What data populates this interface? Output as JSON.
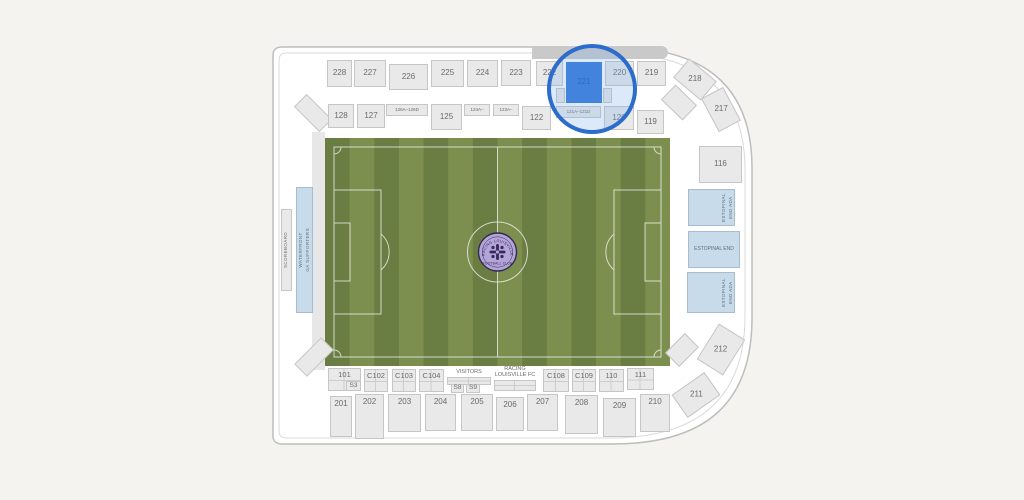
{
  "selection": {
    "selected_section": "221"
  },
  "colors": {
    "page_background": "#f5f3f0",
    "bowl_interior": "#ffffff",
    "outline": "#bdbdbd",
    "inner_outline": "#d9d9d9",
    "section_fill": "#e9e9e9",
    "section_border": "#c6c6c6",
    "blue_section_fill": "#c7dbeb",
    "blue_section_border": "#a6bdd1",
    "highlight_fill": "#2d74d9",
    "highlight_ring": "#2b6ccd",
    "stripe_dark": "#6a7d42",
    "stripe_light": "#7c8f4f",
    "field_line": "#ffffff",
    "logo_fill": "#b3a4d9",
    "logo_ring": "#322a52"
  },
  "field_logo": {
    "top_text": "RACING LOUISVILLE",
    "bottom_text": "FOOTBALL CLUB"
  },
  "sections": [
    {
      "name": "north-canopy",
      "label": "",
      "kind": "band",
      "x": 532,
      "y": 46,
      "w": 136,
      "h": 13,
      "interactable": false
    },
    {
      "name": "west-walkway",
      "label": "",
      "kind": "plain",
      "x": 312,
      "y": 132,
      "w": 13,
      "h": 238,
      "interactable": false
    },
    {
      "name": "section-corner-nw",
      "label": "",
      "x": 295,
      "y": 104,
      "w": 36,
      "h": 18,
      "rot": 45,
      "interactable": false
    },
    {
      "name": "section-corner-sw",
      "label": "",
      "x": 295,
      "y": 348,
      "w": 38,
      "h": 18,
      "rot": -45,
      "interactable": false
    },
    {
      "name": "section-corner-ne",
      "label": "",
      "x": 664,
      "y": 92,
      "w": 30,
      "h": 21,
      "rot": 44,
      "interactable": false
    },
    {
      "name": "section-corner-se",
      "label": "",
      "x": 668,
      "y": 340,
      "w": 28,
      "h": 20,
      "rot": -45,
      "interactable": false
    },
    {
      "label": "228",
      "x": 327,
      "y": 60,
      "w": 25,
      "h": 27
    },
    {
      "label": "227",
      "x": 354,
      "y": 60,
      "w": 32,
      "h": 27
    },
    {
      "label": "226",
      "x": 389,
      "y": 64,
      "w": 39,
      "h": 26
    },
    {
      "label": "225",
      "x": 431,
      "y": 60,
      "w": 33,
      "h": 27
    },
    {
      "label": "224",
      "x": 467,
      "y": 60,
      "w": 31,
      "h": 27
    },
    {
      "label": "223",
      "x": 501,
      "y": 60,
      "w": 30,
      "h": 26
    },
    {
      "label": "222",
      "x": 536,
      "y": 61,
      "w": 27,
      "h": 25
    },
    {
      "name": "stair-221-left",
      "label": "",
      "x": 556,
      "y": 88,
      "w": 9,
      "h": 15,
      "interactable": false
    },
    {
      "name": "stair-221-right",
      "label": "",
      "x": 603,
      "y": 88,
      "w": 9,
      "h": 15,
      "interactable": false
    },
    {
      "label": "221",
      "kind": "highlight",
      "x": 566,
      "y": 62,
      "w": 36,
      "h": 41
    },
    {
      "label": "220",
      "x": 605,
      "y": 61,
      "w": 29,
      "h": 25
    },
    {
      "label": "219",
      "x": 637,
      "y": 61,
      "w": 29,
      "h": 25
    },
    {
      "label": "218",
      "x": 677,
      "y": 67,
      "w": 36,
      "h": 25,
      "rot": 40
    },
    {
      "label": "217",
      "x": 702,
      "y": 97,
      "w": 38,
      "h": 25,
      "rot": 62
    },
    {
      "label": "128",
      "x": 328,
      "y": 104,
      "w": 26,
      "h": 24
    },
    {
      "label": "127",
      "x": 357,
      "y": 104,
      "w": 28,
      "h": 24
    },
    {
      "label": "126A–126D",
      "x": 386,
      "y": 104,
      "w": 42,
      "h": 12,
      "fs": 4.5
    },
    {
      "label": "125",
      "x": 431,
      "y": 104,
      "w": 31,
      "h": 26
    },
    {
      "label": "124A–",
      "x": 464,
      "y": 104,
      "w": 26,
      "h": 12,
      "fs": 4.5
    },
    {
      "label": "123A–",
      "x": 493,
      "y": 104,
      "w": 26,
      "h": 12,
      "fs": 4.5
    },
    {
      "label": "122",
      "x": 522,
      "y": 106,
      "w": 29,
      "h": 24
    },
    {
      "label": "121A–121D",
      "x": 556,
      "y": 106,
      "w": 45,
      "h": 12,
      "fs": 4.5
    },
    {
      "label": "120",
      "x": 604,
      "y": 106,
      "w": 30,
      "h": 24
    },
    {
      "label": "119",
      "x": 637,
      "y": 110,
      "w": 27,
      "h": 24
    },
    {
      "label": "116",
      "x": 699,
      "y": 146,
      "w": 43,
      "h": 37
    },
    {
      "name": "section-estopinal-end-ada-north",
      "label": "ESTOPINAL END ADA",
      "kind": "blue",
      "x": 688,
      "y": 189,
      "w": 47,
      "h": 37,
      "vert": true,
      "fs": 4.5,
      "align": "end"
    },
    {
      "name": "section-estopinal-end",
      "label": "ESTOPINAL END",
      "kind": "blue",
      "x": 688,
      "y": 231,
      "w": 52,
      "h": 37,
      "fs": 5
    },
    {
      "name": "section-estopinal-end-ada-south",
      "label": "ESTOPINAL END ADA",
      "kind": "blue",
      "x": 687,
      "y": 272,
      "w": 48,
      "h": 41,
      "vert": true,
      "fs": 4.5,
      "align": "end"
    },
    {
      "label": "212",
      "x": 700,
      "y": 334,
      "w": 42,
      "h": 31,
      "rot": -58
    },
    {
      "label": "211",
      "x": 676,
      "y": 381,
      "w": 40,
      "h": 28,
      "rot": -35
    },
    {
      "name": "section-scoreboard",
      "label": "SCOREBOARD",
      "x": 281,
      "y": 209,
      "w": 11,
      "h": 82,
      "vert": true,
      "fs": 4.5,
      "interactable": false
    },
    {
      "name": "section-waterfront-ga-supporters",
      "label": "WATERFRONT\nGA SUPPORTERS",
      "kind": "blue",
      "x": 296,
      "y": 187,
      "w": 17,
      "h": 126,
      "vert": true,
      "fs": 4.5
    },
    {
      "label": "101",
      "x": 328,
      "y": 368,
      "w": 33,
      "h": 23,
      "cells": true,
      "fs": 7.5
    },
    {
      "label": "S3",
      "x": 346,
      "y": 381,
      "w": 15,
      "h": 10,
      "fs": 6.5
    },
    {
      "label": "C102",
      "x": 364,
      "y": 369,
      "w": 24,
      "h": 23,
      "cells": true,
      "fs": 7.5
    },
    {
      "label": "C103",
      "x": 392,
      "y": 369,
      "w": 24,
      "h": 23,
      "cells": true,
      "fs": 7.5
    },
    {
      "label": "C104",
      "x": 419,
      "y": 369,
      "w": 25,
      "h": 23,
      "cells": true,
      "fs": 7.5
    },
    {
      "name": "visitors-label",
      "label": "VISITORS",
      "kind": "textonly",
      "x": 446,
      "y": 369,
      "w": 46,
      "h": 8,
      "fs": 5.5,
      "interactable": false
    },
    {
      "name": "visitors-boxes",
      "label": "",
      "x": 447,
      "y": 377,
      "w": 44,
      "h": 8,
      "cells": true
    },
    {
      "label": "S8",
      "x": 451,
      "y": 384,
      "w": 13,
      "h": 9,
      "fs": 6.5
    },
    {
      "label": "S9",
      "x": 466,
      "y": 384,
      "w": 14,
      "h": 9,
      "fs": 6.5
    },
    {
      "name": "racing-louisville-fc-label",
      "label": "RACING\nLOUISVILLE FC",
      "kind": "textonly",
      "x": 492,
      "y": 366,
      "w": 46,
      "h": 14,
      "fs": 5.5,
      "interactable": false
    },
    {
      "name": "racing-louisville-boxes",
      "label": "",
      "x": 494,
      "y": 380,
      "w": 42,
      "h": 11,
      "cells": true
    },
    {
      "label": "C108",
      "x": 543,
      "y": 369,
      "w": 26,
      "h": 23,
      "cells": true,
      "fs": 7.5
    },
    {
      "label": "C109",
      "x": 572,
      "y": 369,
      "w": 24,
      "h": 23,
      "cells": true,
      "fs": 7.5
    },
    {
      "label": "110",
      "x": 599,
      "y": 369,
      "w": 25,
      "h": 23,
      "cells": true,
      "fs": 7.5
    },
    {
      "label": "111",
      "x": 627,
      "y": 368,
      "w": 27,
      "h": 22,
      "cells": true,
      "fs": 7.5
    },
    {
      "label": "201",
      "x": 330,
      "y": 396,
      "w": 22,
      "h": 41,
      "ltop": true
    },
    {
      "label": "202",
      "x": 355,
      "y": 394,
      "w": 29,
      "h": 45,
      "ltop": true
    },
    {
      "label": "203",
      "x": 388,
      "y": 394,
      "w": 33,
      "h": 38,
      "ltop": true
    },
    {
      "label": "204",
      "x": 425,
      "y": 394,
      "w": 31,
      "h": 37,
      "ltop": true
    },
    {
      "label": "205",
      "x": 461,
      "y": 394,
      "w": 32,
      "h": 37,
      "ltop": true
    },
    {
      "label": "206",
      "x": 496,
      "y": 397,
      "w": 28,
      "h": 34,
      "ltop": true
    },
    {
      "label": "207",
      "x": 527,
      "y": 394,
      "w": 31,
      "h": 37,
      "ltop": true
    },
    {
      "label": "208",
      "x": 565,
      "y": 395,
      "w": 33,
      "h": 39,
      "ltop": true
    },
    {
      "label": "209",
      "x": 603,
      "y": 398,
      "w": 33,
      "h": 39,
      "ltop": true
    },
    {
      "label": "210",
      "x": 640,
      "y": 394,
      "w": 30,
      "h": 38,
      "ltop": true
    }
  ]
}
